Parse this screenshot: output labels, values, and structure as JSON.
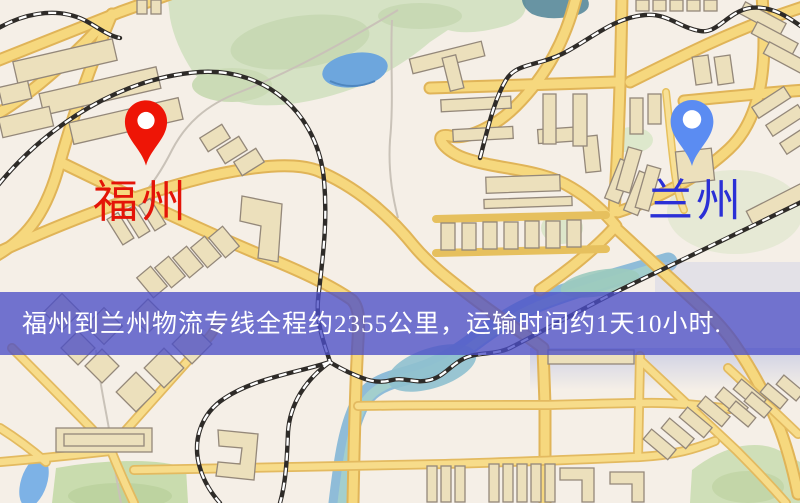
{
  "map": {
    "origin": {
      "label": "福州",
      "pin_color": "#ee1506",
      "label_color": "#e41408"
    },
    "destination": {
      "label": "兰州",
      "pin_color": "#5b8cf2",
      "label_color": "#2b30d6"
    },
    "banner": {
      "text": "福州到兰州物流专线全程约2355公里，运输时间约1天10小时.",
      "background": "rgba(75,78,199,0.78)",
      "text_color": "#ffffff"
    },
    "palette": {
      "map_background": "#f5efe7",
      "road_fill": "#f6d87e",
      "road_edge": "#e0b458",
      "park_green": "#d5e2c4",
      "water_blue": "#6da6dd",
      "river_teal": "#8fbcd8",
      "railway_dark": "#2e2b28",
      "building_tan": "#ece0bc"
    }
  }
}
